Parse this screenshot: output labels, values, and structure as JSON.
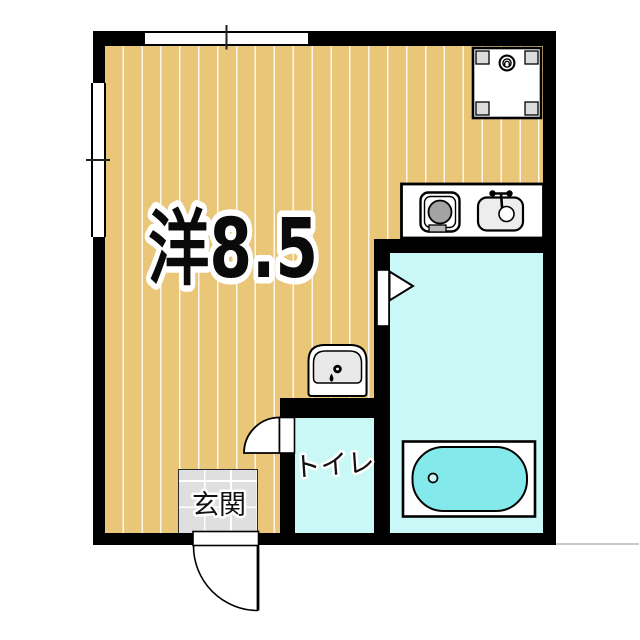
{
  "floorplan": {
    "labels": {
      "main_room": "洋8.5",
      "toilet": "トイレ",
      "entrance": "玄関"
    },
    "colors": {
      "wall": "#000000",
      "wood_floor": "#e9c678",
      "floor_stripe": "#ffffff",
      "wet_area_floor": "#c9f8f7",
      "bathtub_fill": "#84e9ea",
      "entrance_tile": "#dfdfdf",
      "fixture_outline": "#000000",
      "stove_burner": "#a3a3a3"
    }
  }
}
